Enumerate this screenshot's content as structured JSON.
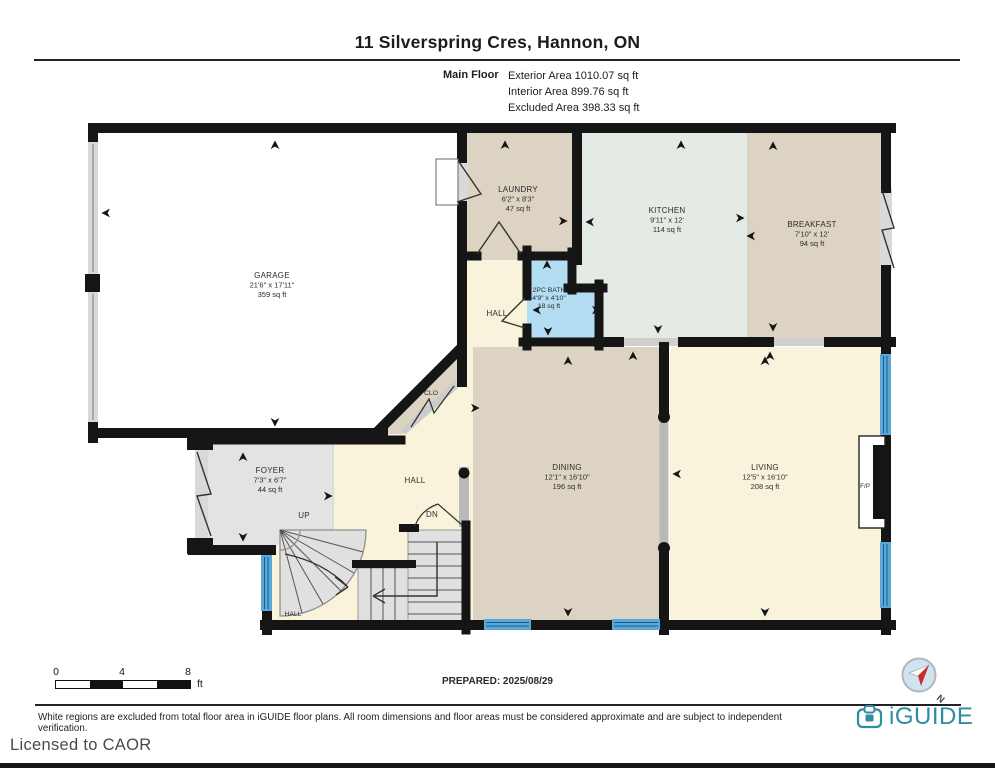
{
  "header": {
    "title": "11 Silverspring Cres, Hannon, ON",
    "floor_label": "Main Floor",
    "exterior_area": "Exterior Area 1010.07 sq ft",
    "interior_area": "Interior Area 899.76 sq ft",
    "excluded_area": "Excluded Area 398.33 sq ft"
  },
  "rooms": {
    "garage": {
      "name": "GARAGE",
      "dims": "21'6\" x 17'11\"",
      "area": "359 sq ft"
    },
    "laundry": {
      "name": "LAUNDRY",
      "dims": "6'2\" x 8'3\"",
      "area": "47 sq ft"
    },
    "kitchen": {
      "name": "KITCHEN",
      "dims": "9'11\" x 12'",
      "area": "114 sq ft"
    },
    "breakfast": {
      "name": "BREAKFAST",
      "dims": "7'10\" x 12'",
      "area": "94 sq ft"
    },
    "bath": {
      "name": "2PC BATH",
      "dims": "4'9\" x 4'10\"",
      "area": "18 sq ft"
    },
    "foyer": {
      "name": "FOYER",
      "dims": "7'3\" x 6'7\"",
      "area": "44 sq ft"
    },
    "dining": {
      "name": "DINING",
      "dims": "12'1\" x 16'10\"",
      "area": "196 sq ft"
    },
    "living": {
      "name": "LIVING",
      "dims": "12'5\" x 16'10\"",
      "area": "208 sq ft"
    },
    "hall_upper": "HALL",
    "hall_center": "HALL",
    "hall_lower": "HALL",
    "closet": "CLO",
    "fireplace": "F/P",
    "up": "UP",
    "down": "DN"
  },
  "scale_bar": {
    "tick0": "0",
    "tick1": "4",
    "tick2": "8",
    "unit": "ft"
  },
  "prepared": "PREPARED: 2025/08/29",
  "compass": {
    "north_label": "N"
  },
  "footer": {
    "disclaimer": "White regions are excluded from total floor area in iGUIDE floor plans. All room dimensions and floor areas must be considered approximate and are subject to independent verification.",
    "brand": "iGUIDE",
    "license": "Licensed to CAOR"
  },
  "colors": {
    "wall": "#151515",
    "floor_tan": "#ddd3c3",
    "floor_mint": "#e4ebe4",
    "floor_cream": "#faf3dc",
    "floor_bath_blue": "#b3ddf2",
    "floor_gray": "#e3e3e3",
    "window_blue": "#58a9da",
    "brand_teal": "#2e8ca3",
    "compass_red": "#cc2b2b"
  }
}
